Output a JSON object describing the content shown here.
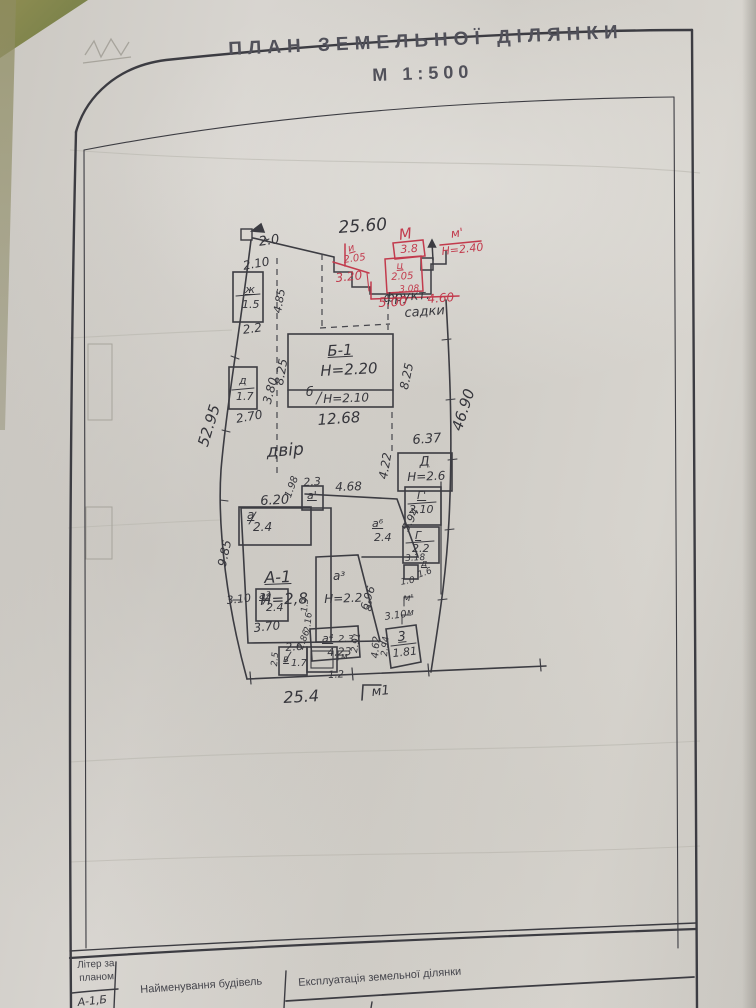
{
  "title": {
    "line1": "ПЛАН ЗЕМЕЛЬНОЇ ДІЛЯНКИ",
    "line2": "М 1:500"
  },
  "colors": {
    "ink": "#36363c",
    "red_ink": "#c23b4d",
    "paper": "#d4d1cb",
    "olive": "#8f8d52"
  },
  "plan": {
    "dims": {
      "top": "25.60",
      "left": "52.95",
      "right": "46.90",
      "bottom": "25.4",
      "corner": "2.0"
    },
    "labels": {
      "yard": "двір",
      "orchard1": "фрукт.",
      "orchard2": "садки",
      "mark_m1": "м1",
      "mark_m_prime": "м'",
      "mark_m_a": "м",
      "mark_m_b": "м"
    },
    "shed_zh": {
      "top": "2.10",
      "letter": "ж",
      "value": "1.5",
      "side": "4.85",
      "bottom": "2.2"
    },
    "shed_d": {
      "letter": "д",
      "value": "1.7",
      "bottom": "2.70",
      "side": "3.80"
    },
    "b1": {
      "name": "Б-1",
      "height": "Н=2.20",
      "left": "8.25",
      "right": "8.25",
      "strip_letter": "б",
      "strip_height": "Н=2.10",
      "bottom": "12.68"
    },
    "bld_d": {
      "name": "Д",
      "height": "Н=2.6",
      "top": "6.37",
      "side": "4.22"
    },
    "house": {
      "name": "А-1",
      "height": "Н=2,8",
      "side": "9.85",
      "d198": "1.98",
      "d23": "2.3",
      "d468": "4.68",
      "d620": "6.20",
      "d594": "5.94",
      "a_prime": "а'",
      "a": "а",
      "a_val": "2.4",
      "a6": "а⁶",
      "a6_val": "2.4",
      "a2": "а²",
      "a2_val": "2.4",
      "d310": "3.10",
      "d370": "3.70",
      "a3": "а³",
      "a3_height": "Н=2.2",
      "d696": "6.96",
      "a5": "а⁵",
      "a4": "а⁴",
      "a4_val": "2.3",
      "d423": "4.23",
      "d216": "2.16",
      "d13": "1.3",
      "d286": "2.86",
      "v": "в",
      "v_val": "1.7",
      "d26": "2.6",
      "d25": "2.5",
      "d12": "1.2",
      "d291": "2.91"
    },
    "right_rooms": {
      "g1": "Г'",
      "g1_val": "2.10",
      "g2": "Г",
      "g2_val": "2.2",
      "d318": "3.18",
      "d_small": "д",
      "d_small_w": "1.6",
      "d_small_h": "1.0",
      "r3": "3",
      "r3_val": "1.81",
      "d310": "3.10",
      "d462": "4.62",
      "d294": "2.94"
    },
    "red": {
      "m": "М",
      "m_prime": "м'",
      "v38": "3.8",
      "i": "и",
      "i_val": "2.05",
      "c": "ц",
      "c_val": "2.05",
      "v320": "3.20",
      "v308": "3.08",
      "v500": "5.00",
      "v460": "4.60",
      "h240": "Н=2.40"
    }
  },
  "table": {
    "col1_line1": "Літер за",
    "col1_line2": "планом",
    "col2": "Найменування будівель",
    "col3": "Експлуатація земельної ділянки",
    "partial_row": "А-1,Б"
  }
}
